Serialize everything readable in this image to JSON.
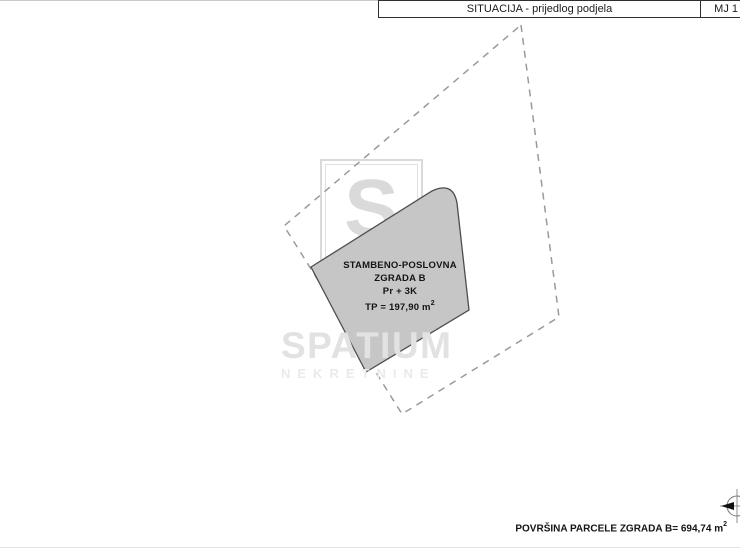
{
  "title_bar": {
    "title": "SITUACIJA - prijedlog podjela",
    "scale": "MJ 1"
  },
  "building": {
    "name_line1": "STAMBENO-POSLOVNA",
    "name_line2": "ZGRADA B",
    "floors": "Pr + 3K",
    "area_label": "TP = 197,90 m",
    "area_sup": "2"
  },
  "parcel": {
    "area_label": "POVRŠINA PARCELE ZGRADA B= 694,74 m",
    "area_sup": "2"
  },
  "watermark": {
    "logo_letter": "S",
    "brand": "SPATIUM",
    "brand_sub": "NEKRETNINE"
  },
  "icons": {
    "compass": "compass-rose-north-icon"
  },
  "colors": {
    "building_fill": "#c6c6c6",
    "building_stroke": "#4d4d4d",
    "parcel_dash": "#9a9a9a",
    "watermark_gray": "#e2e2e2"
  }
}
